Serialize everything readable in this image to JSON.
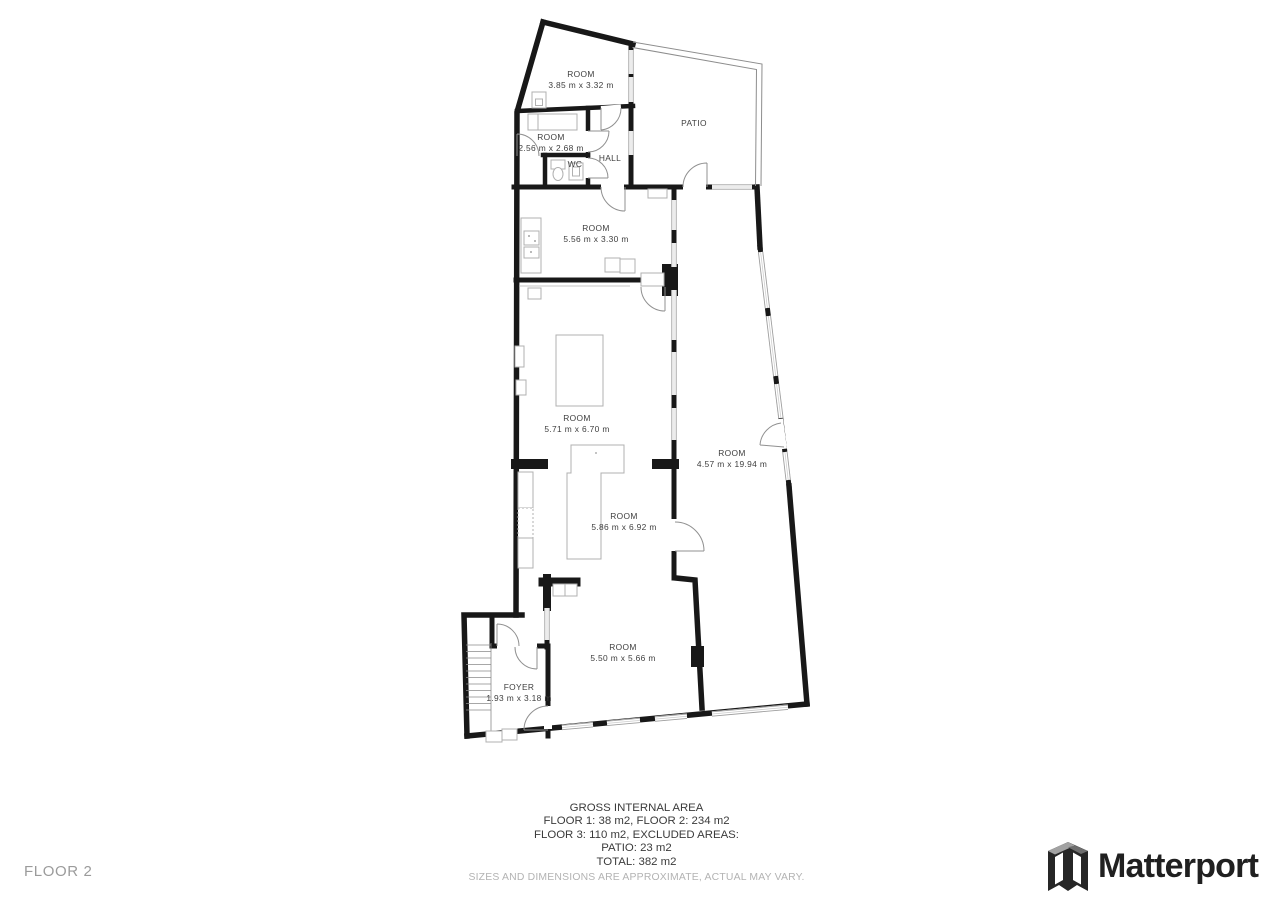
{
  "floor_label": "FLOOR 2",
  "rooms": {
    "r385": {
      "name": "ROOM",
      "dims": "3.85 m x 3.32 m"
    },
    "r256": {
      "name": "ROOM",
      "dims": "2.56 m x 2.68 m"
    },
    "wc": {
      "name": "WC"
    },
    "hall": {
      "name": "HALL"
    },
    "patio": {
      "name": "PATIO"
    },
    "r556": {
      "name": "ROOM",
      "dims": "5.56 m x 3.30 m"
    },
    "r571": {
      "name": "ROOM",
      "dims": "5.71 m x 6.70 m"
    },
    "r586": {
      "name": "ROOM",
      "dims": "5.86 m x 6.92 m"
    },
    "r457": {
      "name": "ROOM",
      "dims": "4.57 m x 19.94 m"
    },
    "r550": {
      "name": "ROOM",
      "dims": "5.50 m x 5.66 m"
    },
    "foyer": {
      "name": "FOYER",
      "dims": "1.93 m x 3.18 m"
    }
  },
  "footer": {
    "line1": "GROSS INTERNAL AREA",
    "line2": "FLOOR 1: 38 m2, FLOOR 2: 234 m2",
    "line3": "FLOOR 3: 110 m2, EXCLUDED AREAS:",
    "line4": "PATIO: 23 m2",
    "line5": "TOTAL: 382 m2",
    "disclaimer": "SIZES AND DIMENSIONS ARE APPROXIMATE, ACTUAL MAY VARY."
  },
  "brand": {
    "name": "Matterport",
    "icon": "matterport-logo-mark"
  },
  "colors": {
    "wall": "#181818",
    "window_edge": "#9e9e9e",
    "furniture": "#b0b0b0",
    "label": "#3e3e3e",
    "muted_gray": "#9b9b9b",
    "brand_dark": "#202020"
  }
}
